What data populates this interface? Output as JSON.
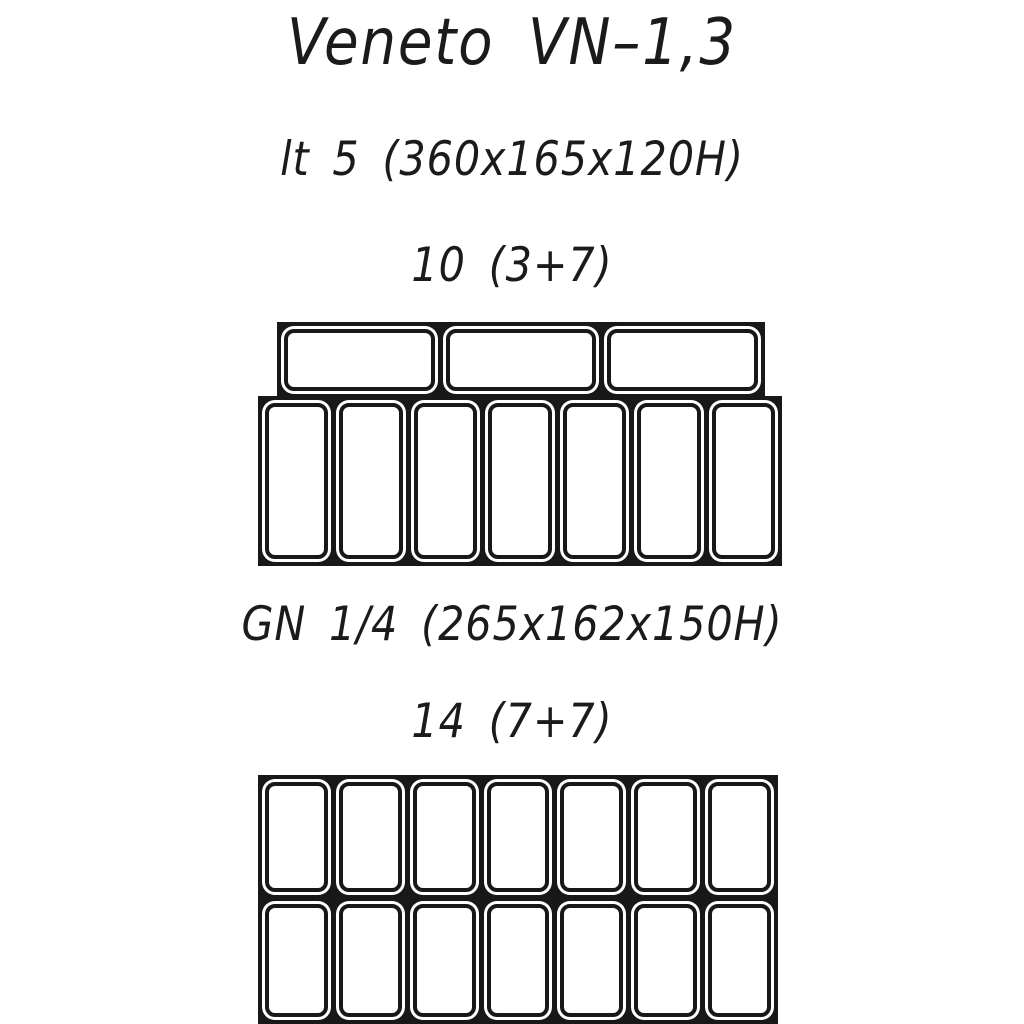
{
  "drawing": {
    "title": "Veneto VN–1,3",
    "line_color": "#181818",
    "text_color": "#1b1b1b",
    "sections": [
      {
        "pan_spec": "lt 5 (360x165x120H)",
        "pan_count": "10 (3+7)",
        "rows": [
          {
            "pans": 3,
            "orientation": "horizontal"
          },
          {
            "pans": 7,
            "orientation": "vertical"
          }
        ]
      },
      {
        "pan_spec": "GN 1/4 (265x162x150H)",
        "pan_count": "14 (7+7)",
        "rows": [
          {
            "pans": 7,
            "orientation": "vertical"
          },
          {
            "pans": 7,
            "orientation": "vertical"
          }
        ]
      }
    ]
  }
}
